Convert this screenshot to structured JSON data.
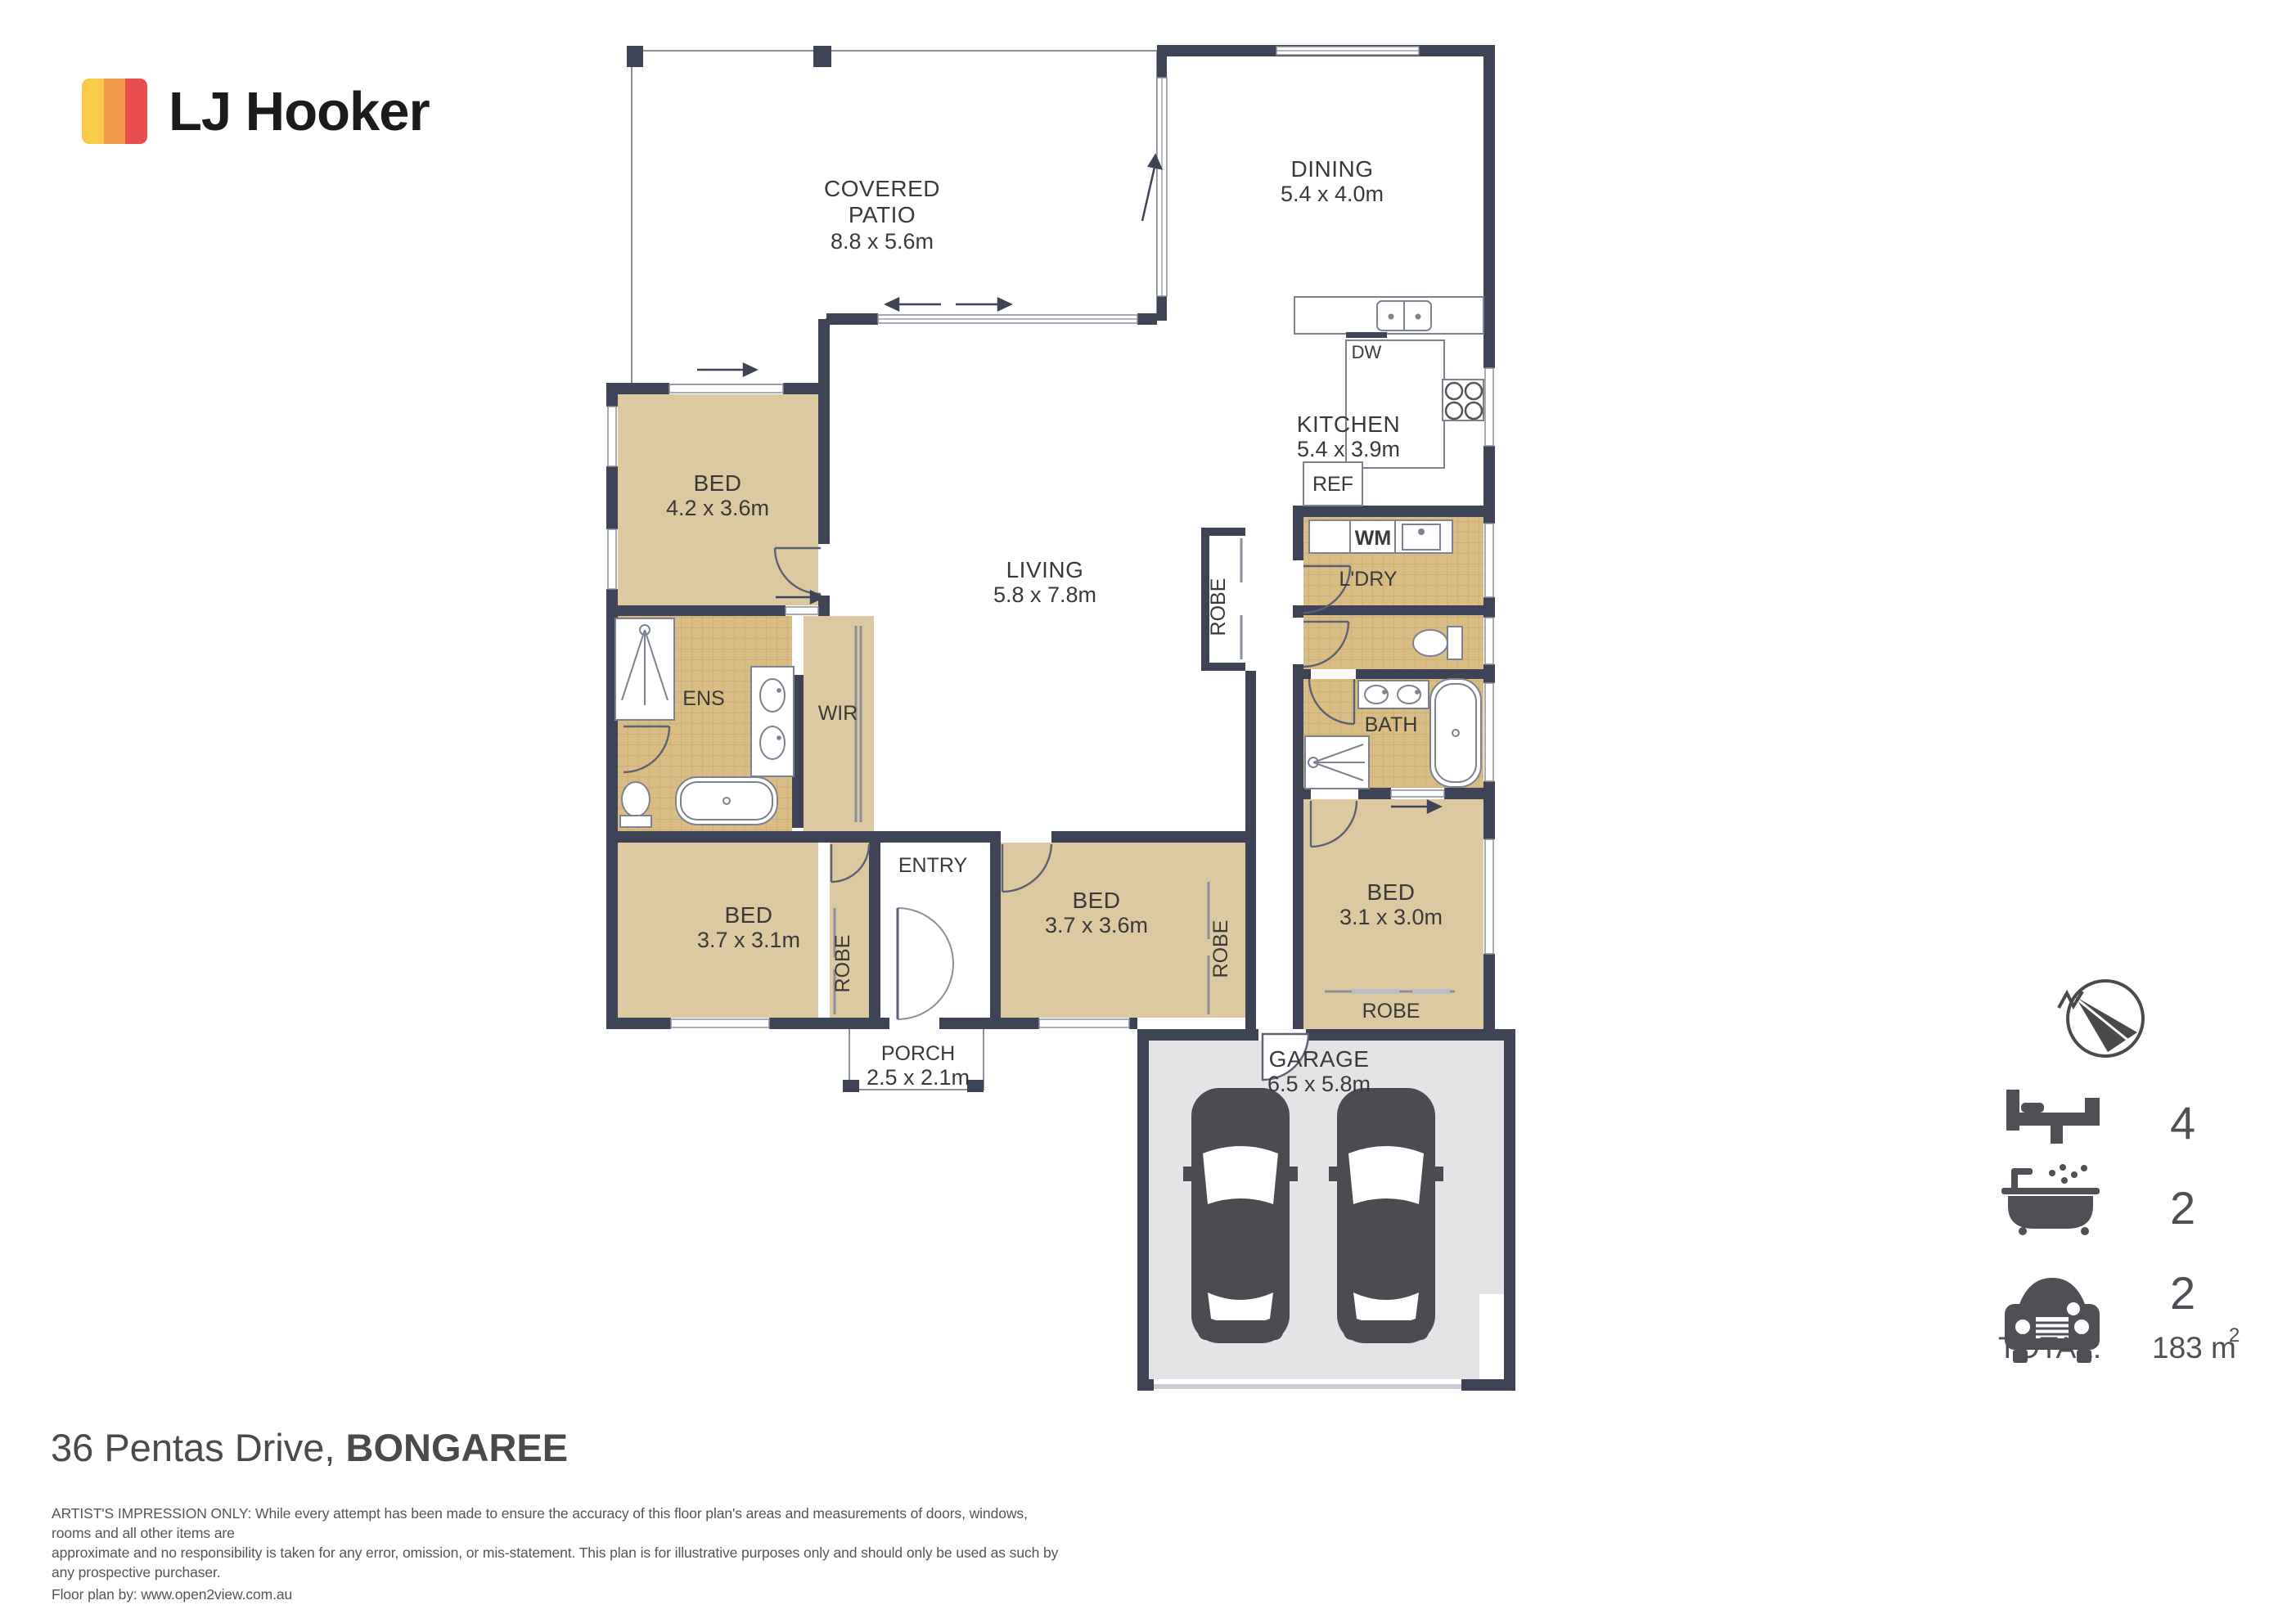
{
  "brand": {
    "name": "LJ Hooker",
    "colors": {
      "yellow": "#FACB4B",
      "orange": "#F2994B",
      "red": "#E94D50"
    }
  },
  "plan": {
    "colors": {
      "wall": "#3e4456",
      "carpet": "#dcc9a1",
      "tile": "#d9bd85",
      "garage_floor": "#e4e4e7",
      "outline": "#8a8f99"
    },
    "rooms": {
      "patio": {
        "l1": "COVERED",
        "l2": "PATIO",
        "dims": "8.8 x 5.6m"
      },
      "dining": {
        "label": "DINING",
        "dims": "5.4 x 4.0m"
      },
      "kitchen": {
        "label": "KITCHEN",
        "dims": "5.4 x 3.9m"
      },
      "living": {
        "label": "LIVING",
        "dims": "5.8 x 7.8m"
      },
      "bed1": {
        "label": "BED",
        "dims": "4.2 x 3.6m"
      },
      "ens": {
        "label": "ENS"
      },
      "wir": {
        "label": "WIR"
      },
      "ldry": {
        "label": "L'DRY"
      },
      "bath": {
        "label": "BATH"
      },
      "bed2": {
        "label": "BED",
        "dims": "3.7 x 3.1m"
      },
      "entry": {
        "label": "ENTRY"
      },
      "bed3": {
        "label": "BED",
        "dims": "3.7 x 3.6m"
      },
      "bed4": {
        "label": "BED",
        "dims": "3.1 x 3.0m"
      },
      "porch": {
        "label": "PORCH",
        "dims": "2.5 x 2.1m"
      },
      "garage": {
        "label": "GARAGE",
        "dims": "6.5 x 5.8m"
      }
    },
    "fixtures": {
      "dw": "DW",
      "ref": "REF",
      "wm": "WM"
    },
    "robes": {
      "living": "ROBE",
      "bed2": "ROBE",
      "bed3": "ROBE",
      "bed4": "ROBE"
    }
  },
  "legend": {
    "beds": {
      "icon": "bed-icon",
      "count": "4"
    },
    "baths": {
      "icon": "bath-icon",
      "count": "2"
    },
    "cars": {
      "icon": "car-icon",
      "count": "2"
    },
    "total": {
      "label": "TOTAL:",
      "value": "183 m",
      "sup": "2"
    }
  },
  "footer": {
    "address": {
      "street": "36 Pentas Drive, ",
      "suburb": "BONGAREE"
    },
    "disclaimer": {
      "line1": "ARTIST'S IMPRESSION ONLY: While every attempt has been made to ensure the accuracy of this floor plan's areas and measurements of doors, windows, rooms and all other items are",
      "line2": "approximate and no responsibility is taken for any error, omission, or mis-statement. This plan is for illustrative purposes only and should only be used as such by any prospective purchaser.",
      "credit": "Floor plan by: www.open2view.com.au"
    }
  }
}
